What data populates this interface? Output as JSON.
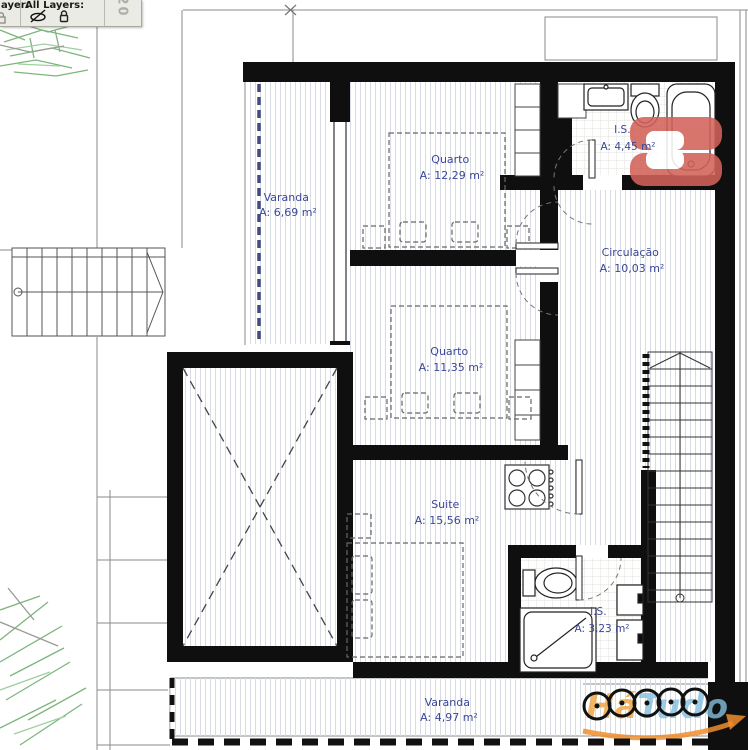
{
  "toolbar": {
    "layer_label": "ayer:",
    "all_layers_label": "All Layers:",
    "count_badge": "20",
    "icons": {
      "hidden_layers": "eye-slash-icon",
      "locked_layers": "lock-icon",
      "clipped_lock": "half-lock-icon"
    }
  },
  "plan": {
    "rooms": [
      {
        "id": "varanda-top",
        "name": "Varanda",
        "area": "A: 6,69 m²"
      },
      {
        "id": "quarto-1",
        "name": "Quarto",
        "area": "A: 12,29 m²"
      },
      {
        "id": "is-1",
        "name": "I.S.",
        "area": "A: 4,45 m²"
      },
      {
        "id": "circulacao",
        "name": "Circulação",
        "area": "A: 10,03 m²"
      },
      {
        "id": "quarto-2",
        "name": "Quarto",
        "area": "A: 11,35 m²"
      },
      {
        "id": "suite",
        "name": "Suite",
        "area": "A: 15,56 m²"
      },
      {
        "id": "is-2",
        "name": "I.S.",
        "area": "A: 3,23 m²"
      },
      {
        "id": "varanda-bottom",
        "name": "Varanda",
        "area": "A: 4,97 m²"
      }
    ]
  },
  "watermark": {
    "brand_orange": "Há",
    "brand_blue": "Tudo"
  },
  "colors": {
    "label_blue": "#3c4797",
    "logo_red": "#d2625a",
    "brand_orange": "#f2a33c",
    "brand_blue": "#85bede",
    "wall_black": "#0f0f0f",
    "tree_green": "#7db57d"
  }
}
